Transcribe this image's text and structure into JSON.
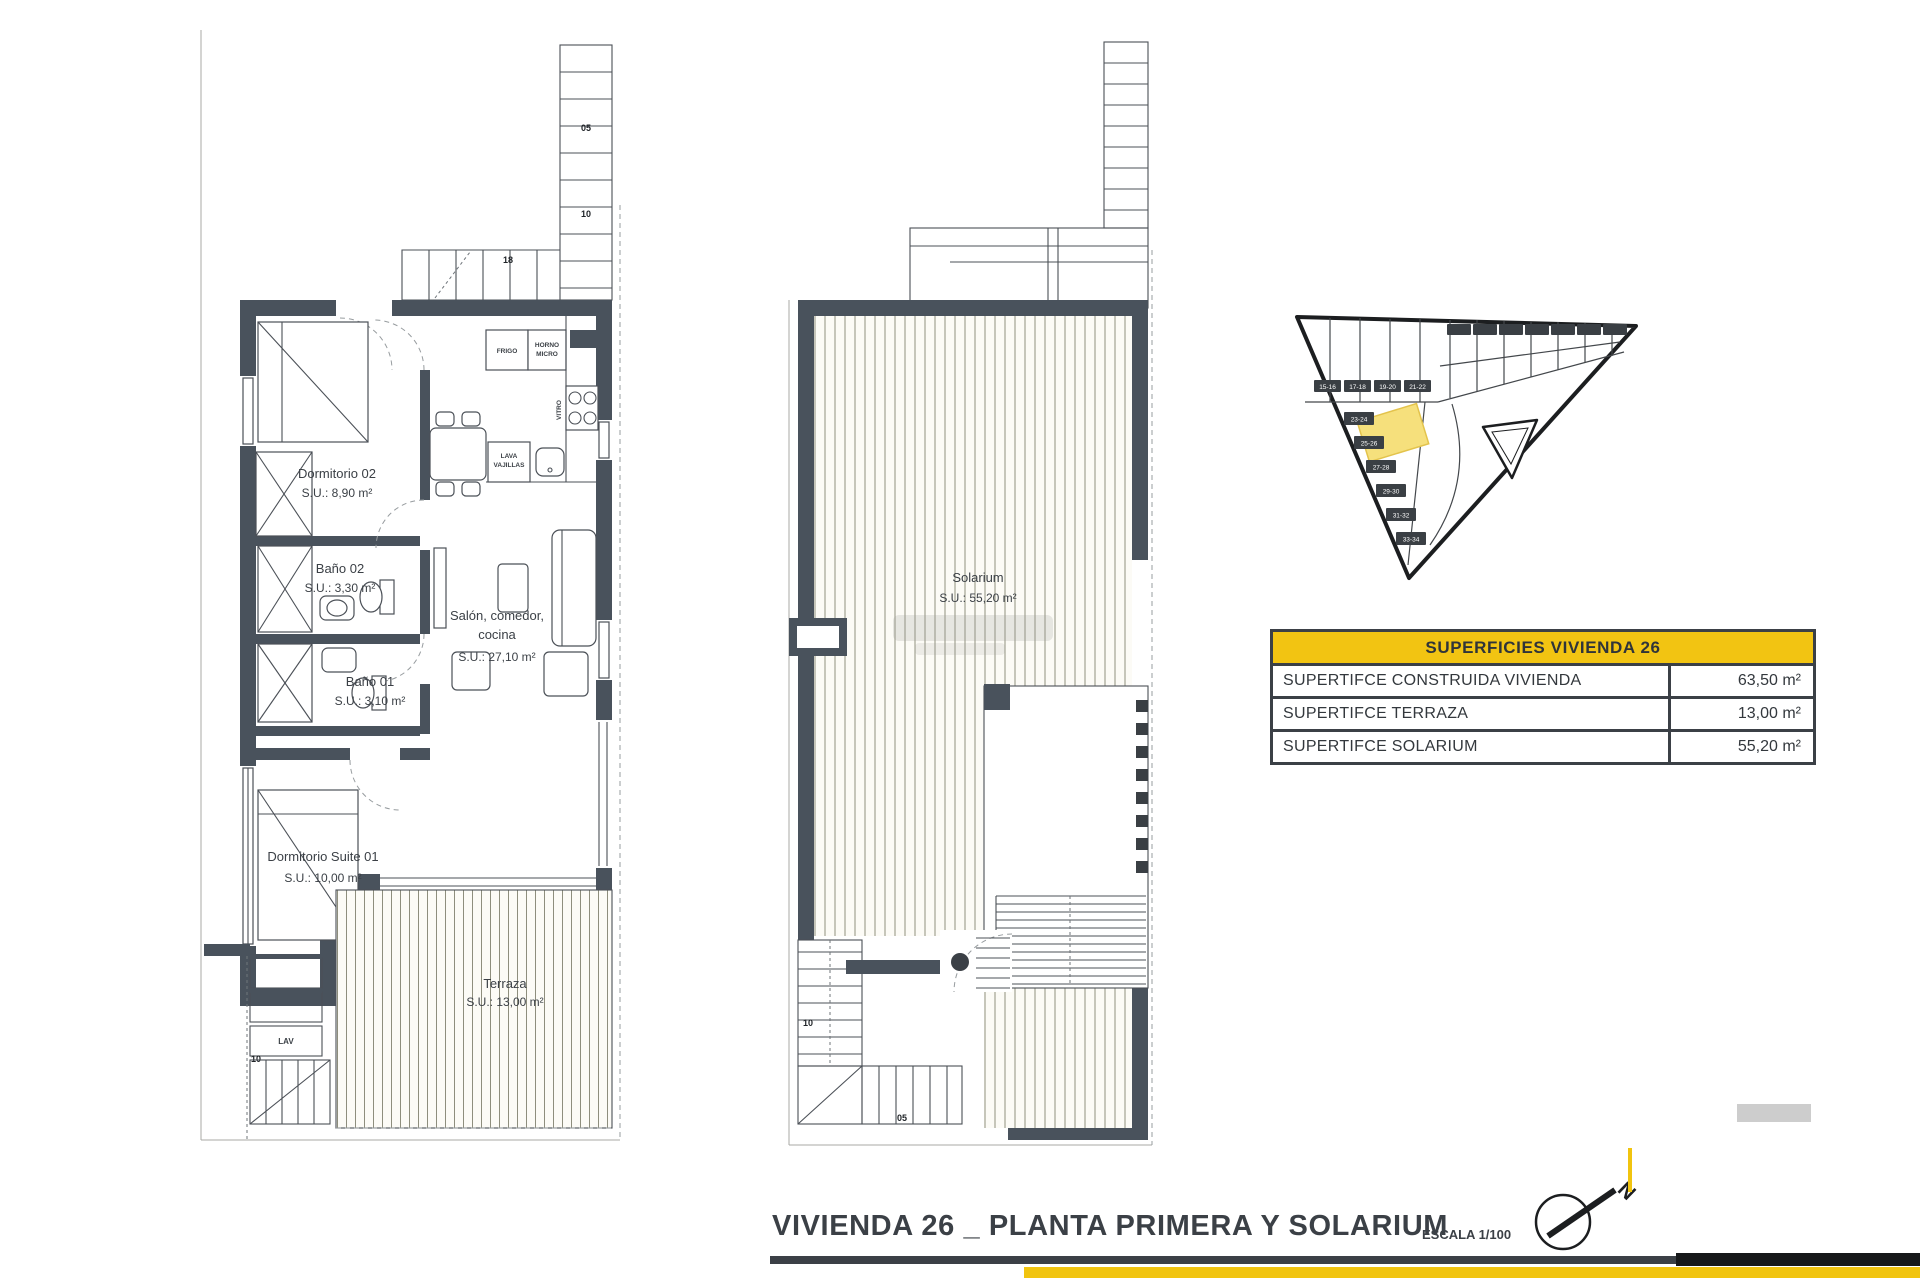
{
  "colors": {
    "wall": "#49525c",
    "accent_yellow": "#f2c412",
    "ink": "#3b4046",
    "hatch": "#8e8e7d",
    "highlight": "#f6e07c"
  },
  "footer": {
    "title": "VIVIENDA 26 _ PLANTA PRIMERA Y SOLARIUM",
    "scale_label": "ESCALA 1/100",
    "north_letter": "N"
  },
  "surfaces_table": {
    "header": "SUPERFICIES VIVIENDA 26",
    "rows": [
      {
        "label": "SUPERTIFCE CONSTRUIDA VIVIENDA",
        "value": "63,50 m²"
      },
      {
        "label": "SUPERTIFCE TERRAZA",
        "value": "13,00 m²"
      },
      {
        "label": "SUPERTIFCE SOLARIUM",
        "value": "55,20 m²"
      }
    ]
  },
  "first_floor_plan": {
    "dormitorio02": {
      "name": "Dormitorio 02",
      "area": "S.U.: 8,90 m²"
    },
    "bano02": {
      "name": "Baño 02",
      "area": "S.U.: 3,30 m²"
    },
    "bano01": {
      "name": "Baño 01",
      "area": "S.U.: 3,10 m²"
    },
    "salon": {
      "line1": "Salón, comedor,",
      "line2": "cocina",
      "area": "S.U.: 27,10 m²"
    },
    "suite": {
      "name": "Dormitorio Suite 01",
      "area": "S.U.: 10,00 m²"
    },
    "terraza": {
      "name": "Terraza",
      "area": "S.U.: 13,00 m²"
    },
    "kitchen": {
      "fridge": "FRIGO",
      "oven_line1": "HORNO",
      "oven_line2": "MICRO",
      "dishwasher_line1": "LAVA",
      "dishwasher_line2": "VAJILLAS",
      "hob": "VITRO"
    },
    "utility": {
      "label": "LAV",
      "step": "10"
    },
    "stair_steps": {
      "s1": "05",
      "s2": "10",
      "s3": "18"
    }
  },
  "solarium_plan": {
    "room": {
      "name": "Solarium",
      "area": "S.U.: 55,20 m²"
    },
    "stair_steps": {
      "up": "10",
      "down": "05"
    }
  },
  "site_plan": {
    "chips_top": [
      "15-16",
      "17-18",
      "19-20",
      "21-22"
    ],
    "chips_side": [
      "23-24",
      "25-26",
      "27-28",
      "29-30",
      "31-32",
      "33-34"
    ]
  }
}
